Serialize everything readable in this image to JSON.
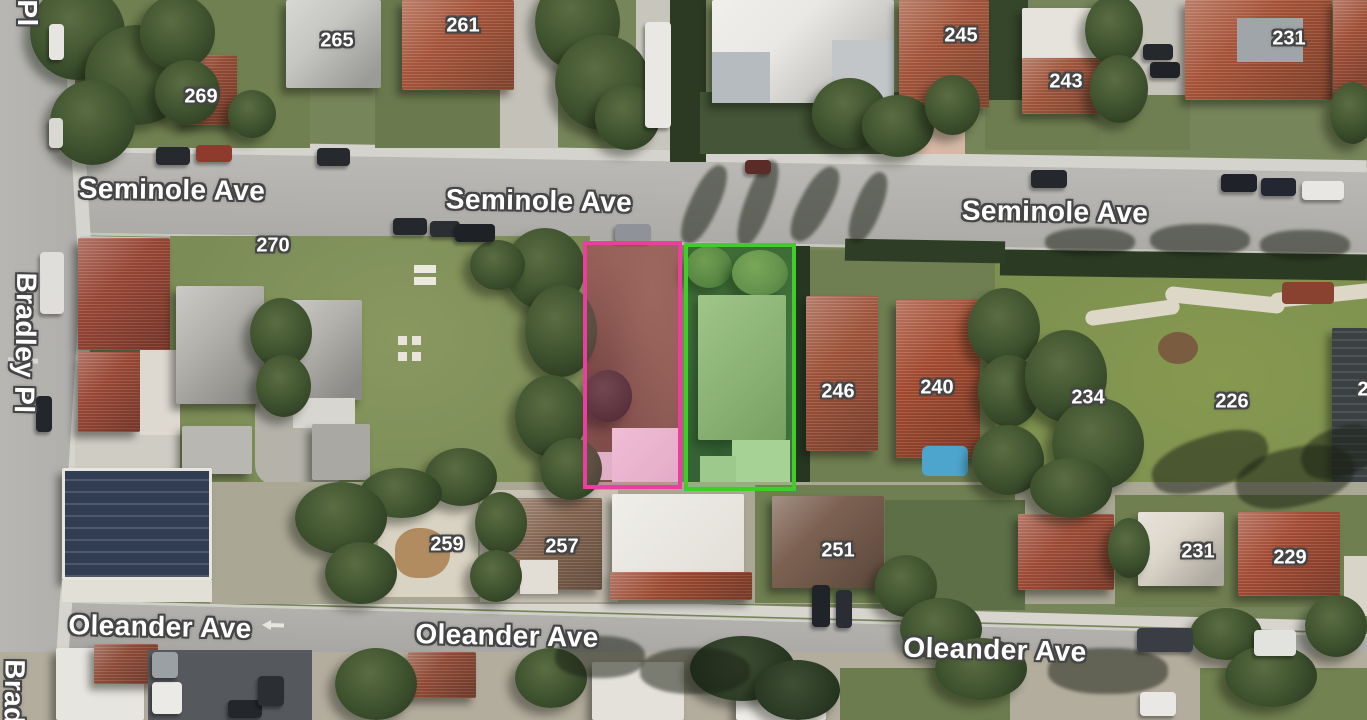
{
  "map": {
    "view": "satellite",
    "label_style": {
      "text_color": "#ffffff",
      "outline_color": "#454545"
    },
    "street_labels": [
      {
        "text": "Pl",
        "x": 27,
        "y": 13,
        "rotate": 90,
        "partial": true
      },
      {
        "text": "Seminole Ave",
        "x": 172,
        "y": 190,
        "rotate": 0.8
      },
      {
        "text": "Seminole Ave",
        "x": 539,
        "y": 201,
        "rotate": 1.0
      },
      {
        "text": "Seminole Ave",
        "x": 1055,
        "y": 212,
        "rotate": 0.8
      },
      {
        "text": "Bradley Pl",
        "x": 25,
        "y": 343,
        "rotate": 91
      },
      {
        "text": "Oleander Ave",
        "x": 160,
        "y": 627,
        "rotate": 1.2
      },
      {
        "text": "Oleander Ave",
        "x": 507,
        "y": 636,
        "rotate": 1.2
      },
      {
        "text": "Oleander Ave",
        "x": 995,
        "y": 650,
        "rotate": 1.5
      },
      {
        "text": "Brad",
        "x": 14,
        "y": 692,
        "rotate": 91,
        "partial": true
      }
    ],
    "house_number_labels": [
      {
        "text": "269",
        "x": 201,
        "y": 97
      },
      {
        "text": "265",
        "x": 337,
        "y": 41
      },
      {
        "text": "261",
        "x": 463,
        "y": 26
      },
      {
        "text": "245",
        "x": 961,
        "y": 36
      },
      {
        "text": "243",
        "x": 1066,
        "y": 82
      },
      {
        "text": "231",
        "x": 1289,
        "y": 39
      },
      {
        "text": "270",
        "x": 273,
        "y": 246
      },
      {
        "text": "246",
        "x": 838,
        "y": 392
      },
      {
        "text": "240",
        "x": 937,
        "y": 388
      },
      {
        "text": "234",
        "x": 1088,
        "y": 398
      },
      {
        "text": "226",
        "x": 1232,
        "y": 402
      },
      {
        "text": "2",
        "x": 1363,
        "y": 390,
        "partial": true
      },
      {
        "text": "259",
        "x": 447,
        "y": 545
      },
      {
        "text": "257",
        "x": 562,
        "y": 547
      },
      {
        "text": "251",
        "x": 838,
        "y": 551
      },
      {
        "text": "231",
        "x": 1198,
        "y": 552
      },
      {
        "text": "229",
        "x": 1290,
        "y": 558
      }
    ],
    "parcel_overlays": [
      {
        "id": "pink-parcel",
        "outline_color": "#ea3f9e",
        "fill_color": "rgba(236,64,156,0.16)",
        "x": 583,
        "y": 241,
        "width": 99,
        "height": 248
      },
      {
        "id": "green-parcel",
        "outline_color": "#3ecd2b",
        "fill_color": "rgba(62,205,43,0.16)",
        "x": 684,
        "y": 243,
        "width": 112,
        "height": 248
      }
    ]
  }
}
